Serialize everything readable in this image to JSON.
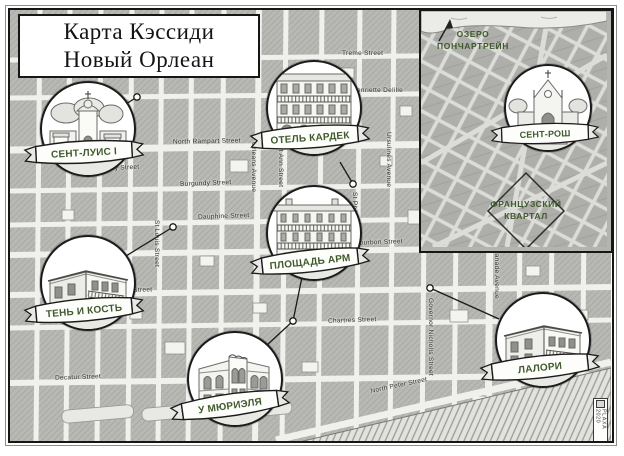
{
  "title": {
    "line1": "Карта Кэссиди",
    "line2": "Новый Орлеан"
  },
  "vignettes": [
    {
      "id": "sent-luis-1",
      "label": "СЕНТ-ЛУИС I"
    },
    {
      "id": "otel-kardek",
      "label": "ОТЕЛЬ КАРДЕК"
    },
    {
      "id": "ten-i-kost",
      "label": "ТЕНЬ И КОСТЬ"
    },
    {
      "id": "ploshchad-arm",
      "label": "ПЛОЩАДЬ АРМ"
    },
    {
      "id": "u-muriela",
      "label": "У МЮРИЭЛЯ"
    },
    {
      "id": "lalori",
      "label": "ЛАЛОРИ"
    },
    {
      "id": "sent-rosh",
      "label": "СЕНТ-РОШ"
    }
  ],
  "inset": {
    "lake_line1": "ОЗЕРО",
    "lake_line2": "ПОНЧАРТРЕЙН",
    "district_line1": "ФРАНЦУЗСКИЙ",
    "district_line2": "КВАРТАЛ"
  },
  "streets": [
    {
      "name": "Treme Street"
    },
    {
      "name": "Henriette Delille"
    },
    {
      "name": "North Rampart Street"
    },
    {
      "name": "Burgundy Street"
    },
    {
      "name": "Burgundy Street"
    },
    {
      "name": "Dauphine Street"
    },
    {
      "name": "Bourbon Street"
    },
    {
      "name": "Royal Street"
    },
    {
      "name": "Chartres Street"
    },
    {
      "name": "Decatur Street"
    },
    {
      "name": "North Peter Street"
    },
    {
      "name": "Orleans Avenue"
    },
    {
      "name": "St Ann Street"
    },
    {
      "name": "St Philip Street"
    },
    {
      "name": "Ursulines Avenue"
    },
    {
      "name": "Governor Nicholls Street"
    },
    {
      "name": "Esplanade Avenue"
    },
    {
      "name": "St Louis Street"
    }
  ],
  "signature": "PLAXA 2020",
  "icons": {
    "north_arrow": "north-arrow"
  },
  "colors": {
    "accent_green": "#3f5a2d",
    "ink": "#1b1b1b",
    "block_gray": "#b9b9b5",
    "street": "#f0f0ed",
    "paper": "#ffffff"
  }
}
